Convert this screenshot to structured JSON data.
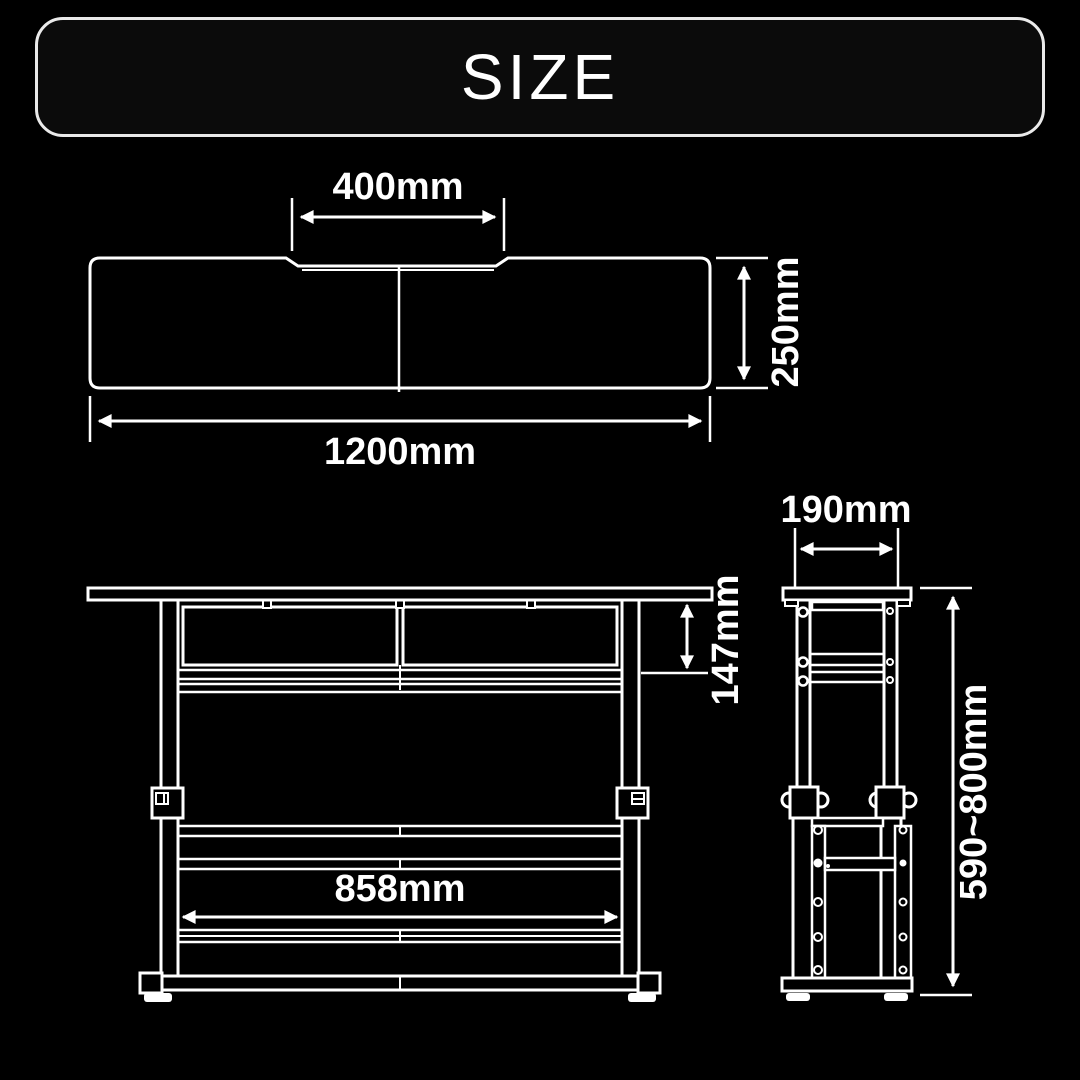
{
  "title": "SIZE",
  "colors": {
    "background": "#000000",
    "line": "#ffffff",
    "title_border": "#eaeaea",
    "title_fill": "#0b0b0b"
  },
  "views": {
    "top": {
      "name": "top-view",
      "labels": {
        "notch_width": "400mm",
        "depth": "250mm",
        "total_width": "1200mm"
      }
    },
    "front": {
      "name": "front-view",
      "labels": {
        "panel_height": "147mm",
        "inner_width": "858mm"
      }
    },
    "side": {
      "name": "side-view",
      "labels": {
        "depth": "190mm",
        "height_range": "590~800mm"
      }
    }
  }
}
